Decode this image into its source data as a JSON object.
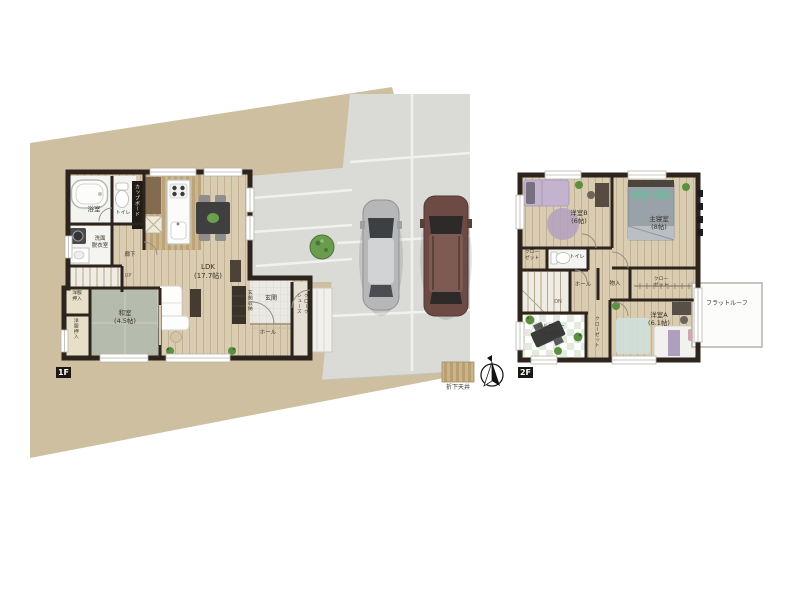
{
  "floor1": {
    "tag": "1F",
    "bath": "浴室",
    "toilet": "トイレ",
    "washroom_1": "洗面",
    "washroom_2": "脱衣室",
    "cupboard": "カップボード",
    "hallway": "廊下",
    "up": "UP",
    "ldk": "LDK",
    "ldk_size": "(17.7帖)",
    "washitsu": "和室",
    "washitsu_size": "(4.5帖)",
    "closet_a_1": "洋服",
    "closet_a_2": "押入",
    "closet_b": "洋服押入",
    "genkan": "玄関",
    "genkan_storage": "玄関収納",
    "shoes_cloak_1": "シューズ",
    "shoes_cloak_2": "クローク",
    "hall": "ホール"
  },
  "floor2": {
    "tag": "2F",
    "bedroom_b": "洋室B",
    "bedroom_b_size": "(6帖)",
    "master_bedroom": "主寝室",
    "master_bedroom_size": "(8帖)",
    "bedroom_a": "洋室A",
    "bedroom_a_size": "(6.1帖)",
    "balcony": "バルコニー",
    "balcony_size": "(4.5帖)",
    "closet_nw_1": "クロー",
    "closet_nw_2": "ゼット",
    "toilet": "トイレ",
    "hall": "ホール",
    "dn": "DN",
    "storage": "物入",
    "closet_e_1": "クロー",
    "closet_e_2": "ゼット",
    "closet_s": "クローゼット",
    "flat_roof": "フラットルーフ"
  },
  "legend": {
    "lowered_ceiling": "折下天井"
  },
  "colors": {
    "site_ground": "#cdbf9f",
    "driveway": "#dadad6",
    "wall": "#2d241d",
    "wood_floor": "#d9ccb1",
    "tatami": "#b6bcad",
    "lowered_ceiling_hatch": "#b89f74",
    "rug_purple": "#b2a0c0",
    "bed_gray": "#9aa2a9",
    "pillow_teal": "#7db1a1",
    "car_silver": "#b6b7b9",
    "car_maroon": "#6d4b44",
    "plant_green": "#679a4d"
  }
}
